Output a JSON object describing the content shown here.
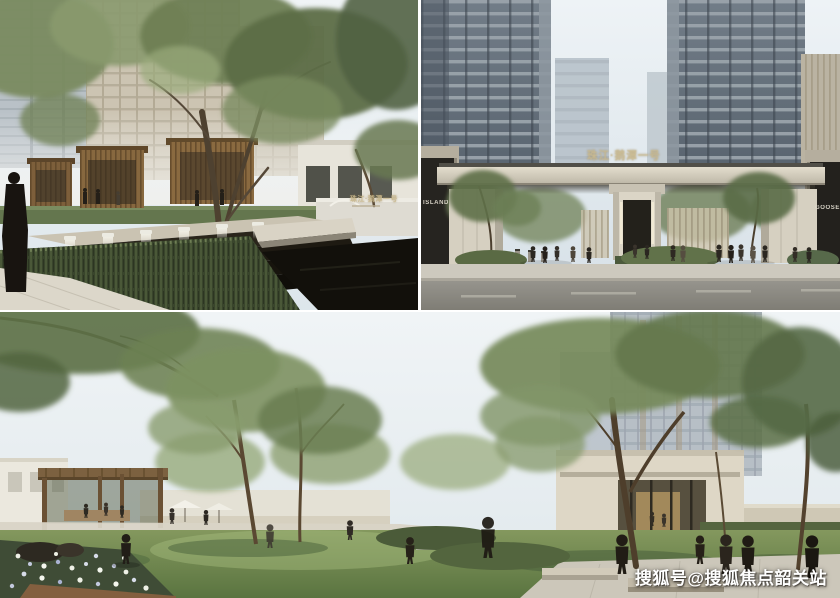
{
  "collage": {
    "watermark": "搜狐号@搜狐焦点韶关站",
    "panels": {
      "waterscape": {
        "alt": "water-cascade-landscape-rendering",
        "sign_text": "珠江·鹅潭一号"
      },
      "gate": {
        "alt": "main-entrance-gate-rendering",
        "sign_text": "珠江·鹅潭一号",
        "left_shop_sign": "ISLAND",
        "right_shop_sign": "GOOSE"
      },
      "courtyard": {
        "alt": "courtyard-garden-rendering"
      }
    }
  },
  "colors": {
    "gold_sign": "#c8b88c",
    "watermark_text": "#ffffff",
    "sky": "#e6edf1",
    "foliage": "#76885c",
    "cascade_stone": "#17140e",
    "lawn": "#6f8850",
    "wood": "#85653f"
  }
}
